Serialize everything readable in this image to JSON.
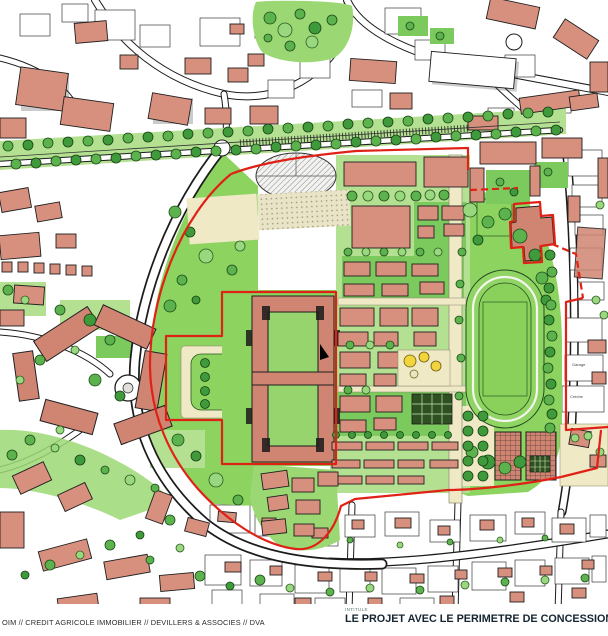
{
  "map": {
    "kind": "urban-masterplan-scan",
    "labels": {
      "garage": "Garage",
      "creche": "Crèche"
    },
    "colors": {
      "building_salmon": "#d7907e",
      "lawn_green": "#8cd35f",
      "tree_green": "#5cb24c",
      "perimeter_red": "#e02116",
      "esplanade_cream": "#efe9c6",
      "caption_ink": "#152530"
    }
  },
  "footer": {
    "credits": "OIM // CREDIT AGRICOLE IMMOBILIER // DEVILLERS & ASSOCIES // DVA",
    "title_label": "INTITULE",
    "title": "LE PROJET AVEC LE PERIMETRE DE CONCESSION ET DE ZAC"
  }
}
